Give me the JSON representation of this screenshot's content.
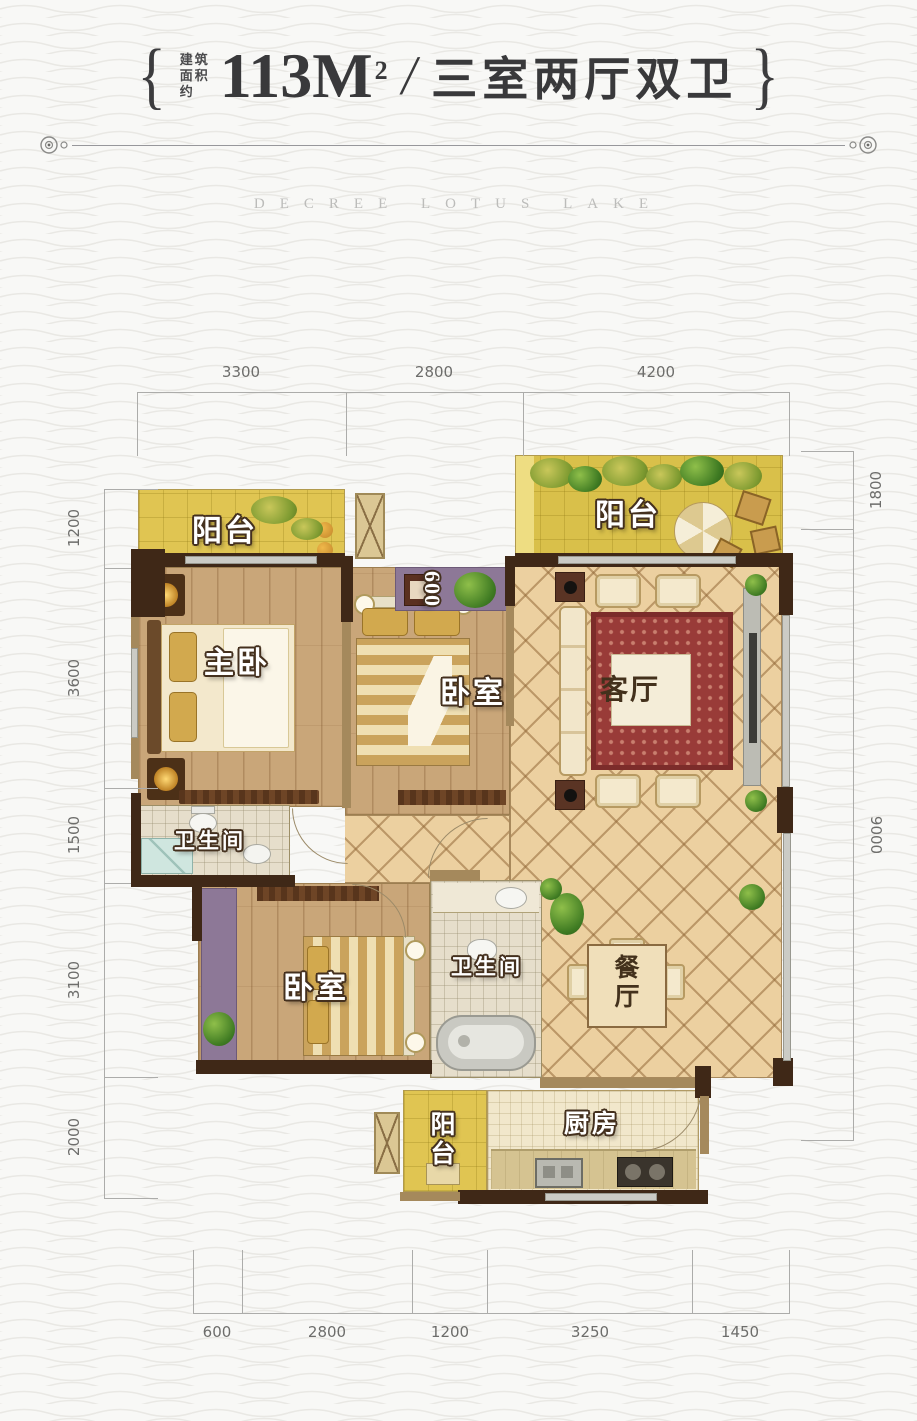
{
  "header": {
    "area_label_lines": [
      "建筑",
      "面积",
      "约"
    ],
    "area_value": "113M",
    "area_sup": "2",
    "separator": "/",
    "layout_title": "三室两厅双卫",
    "ornament_left": "{",
    "ornament_right": "}"
  },
  "subtitle": "DECREE LOTUS LAKE",
  "rooms": {
    "balcony_top_left": "阳台",
    "master_bedroom": "主卧",
    "bedroom_middle": "卧室",
    "living_room": "客厅",
    "balcony_top_right": "阳台",
    "bathroom_master": "卫生间",
    "bedroom_lower": "卧室",
    "bathroom_shared": "卫生间",
    "dining_room": "餐厅",
    "kitchen": "厨房",
    "balcony_service": "阳台"
  },
  "dimensions": {
    "top": [
      "3300",
      "2800",
      "4200"
    ],
    "bottom": [
      "600",
      "2800",
      "1200",
      "3250",
      "1450"
    ],
    "left": [
      "1200",
      "3600",
      "1500",
      "3100",
      "2000"
    ],
    "right": [
      "1800",
      "9000"
    ],
    "inner": "600"
  },
  "colors": {
    "balcony_yellow": "#e0c552",
    "wood_floor": "#c9a679",
    "diamond_tile": "#ecd0a0",
    "bath_tile": "#e6decb",
    "wall_dark": "#3f2817",
    "wall_tan": "#a5895c",
    "planter_purple": "#8d7897",
    "carpet_red": "#993b38",
    "label_outline": "#44301e",
    "dim_line_gray": "#acacaa",
    "header_text": "#39393b"
  }
}
